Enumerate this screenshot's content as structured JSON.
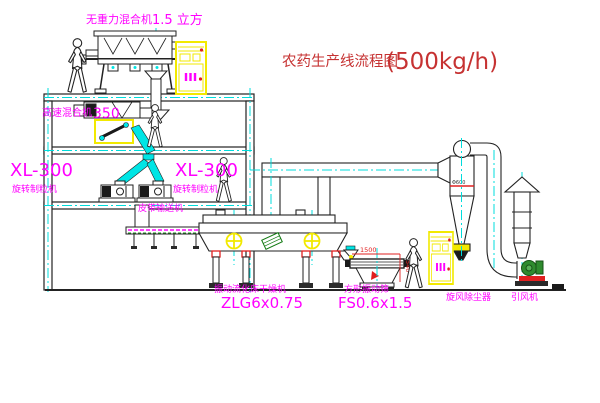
{
  "diagram": {
    "title": {
      "text": "农药生产线流程图",
      "capacity": "(500kg/h)"
    },
    "labels": {
      "gravity_mixer_name": "无重力混合机",
      "gravity_mixer_size": "1.5 立方",
      "high_speed_mixer_name": "高速混合机",
      "high_speed_mixer_size": "350",
      "granulator_left_model": "XL-300",
      "granulator_left_name": "旋转制粒机",
      "granulator_center_model": "XL-300",
      "granulator_center_name": "旋转制粒机",
      "belt_conveyor": "皮带输送机",
      "dryer_name": "振动流化床干燥机",
      "dryer_model": "ZLG6x0.75",
      "sieve_name": "方形振动筛",
      "sieve_model": "FS0.6x1.5",
      "cyclone_name": "旋风除尘器",
      "fan_name": "引风机"
    },
    "dimensions": {
      "cyclone_diameter": "Φ600",
      "sieve_length": "1500",
      "sieve_height": "540"
    },
    "colors": {
      "label_magenta": "#ff00ff",
      "title_red": "#c63232",
      "dimension_red": "#e02020",
      "centerline_cyan": "#00dcdc",
      "chute_cyan": "#00e5e5",
      "cabinet_yellow": "#f2e900",
      "fan_green": "#2e8b2e"
    }
  }
}
